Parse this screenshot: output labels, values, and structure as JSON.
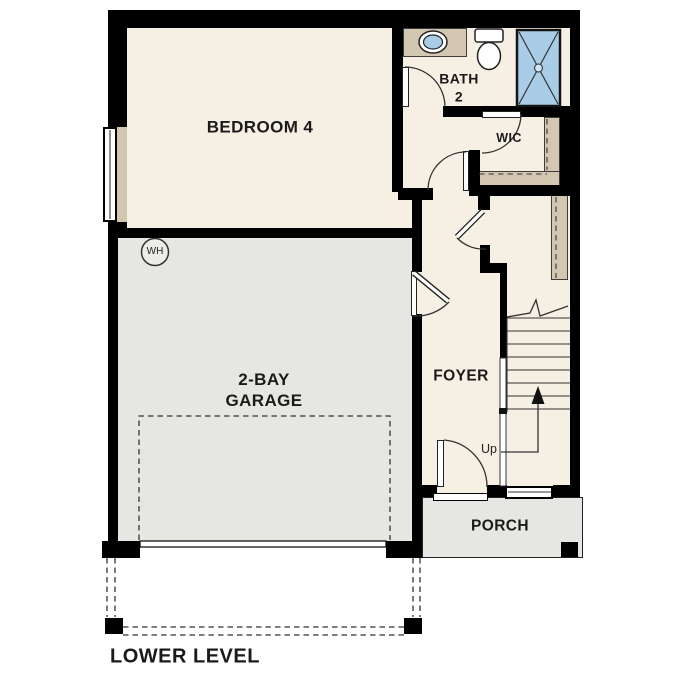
{
  "plan": {
    "title": "LOWER LEVEL",
    "rooms": {
      "bedroom": {
        "label": "BEDROOM 4"
      },
      "bath": {
        "line1": "BATH",
        "line2": "2"
      },
      "wic": {
        "label": "WIC"
      },
      "foyer": {
        "label": "FOYER"
      },
      "garage": {
        "line1": "2-BAY",
        "line2": "GARAGE"
      },
      "porch": {
        "label": "PORCH"
      }
    },
    "annotations": {
      "stairs_direction": "Up",
      "water_heater": "WH"
    },
    "colors": {
      "floor": "#f6efe3",
      "concrete": "#e6e6e3",
      "wall": "#000000",
      "millwork": "#d3c7b2",
      "fixture_blue": "#a9cce7",
      "line": "#333333",
      "ink": "#1a1a1a"
    }
  }
}
